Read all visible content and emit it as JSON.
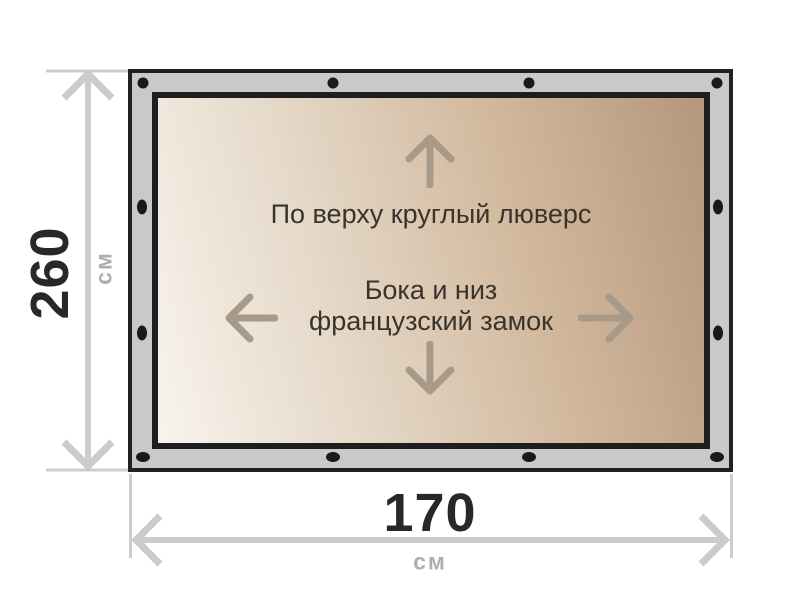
{
  "diagram": {
    "height_dimension": {
      "value": "260",
      "unit": "см"
    },
    "width_dimension": {
      "value": "170",
      "unit": "см"
    },
    "annotations": {
      "top": "По верху круглый люверс",
      "middle_line1": "Бока и низ",
      "middle_line2": "французский замок"
    },
    "icons": {
      "up": "arrow-up-icon",
      "down": "arrow-down-icon",
      "left": "arrow-left-icon",
      "right": "arrow-right-icon",
      "grommet": "grommet-dot",
      "height_arrow": "height-dimension-arrow",
      "width_arrow": "width-dimension-arrow"
    },
    "colors": {
      "frame_gray": "#c9c9c9",
      "frame_border": "#212121",
      "fabric_light": "#f8f4ed",
      "fabric_dark": "#b5977b",
      "dimension_line": "#cccccc",
      "number_text": "#282828",
      "unit_text": "#aeaeae",
      "direction_arrow": "#a79a88",
      "annotation_text": "#39332b",
      "grommet_black": "#1a1a1a"
    }
  }
}
